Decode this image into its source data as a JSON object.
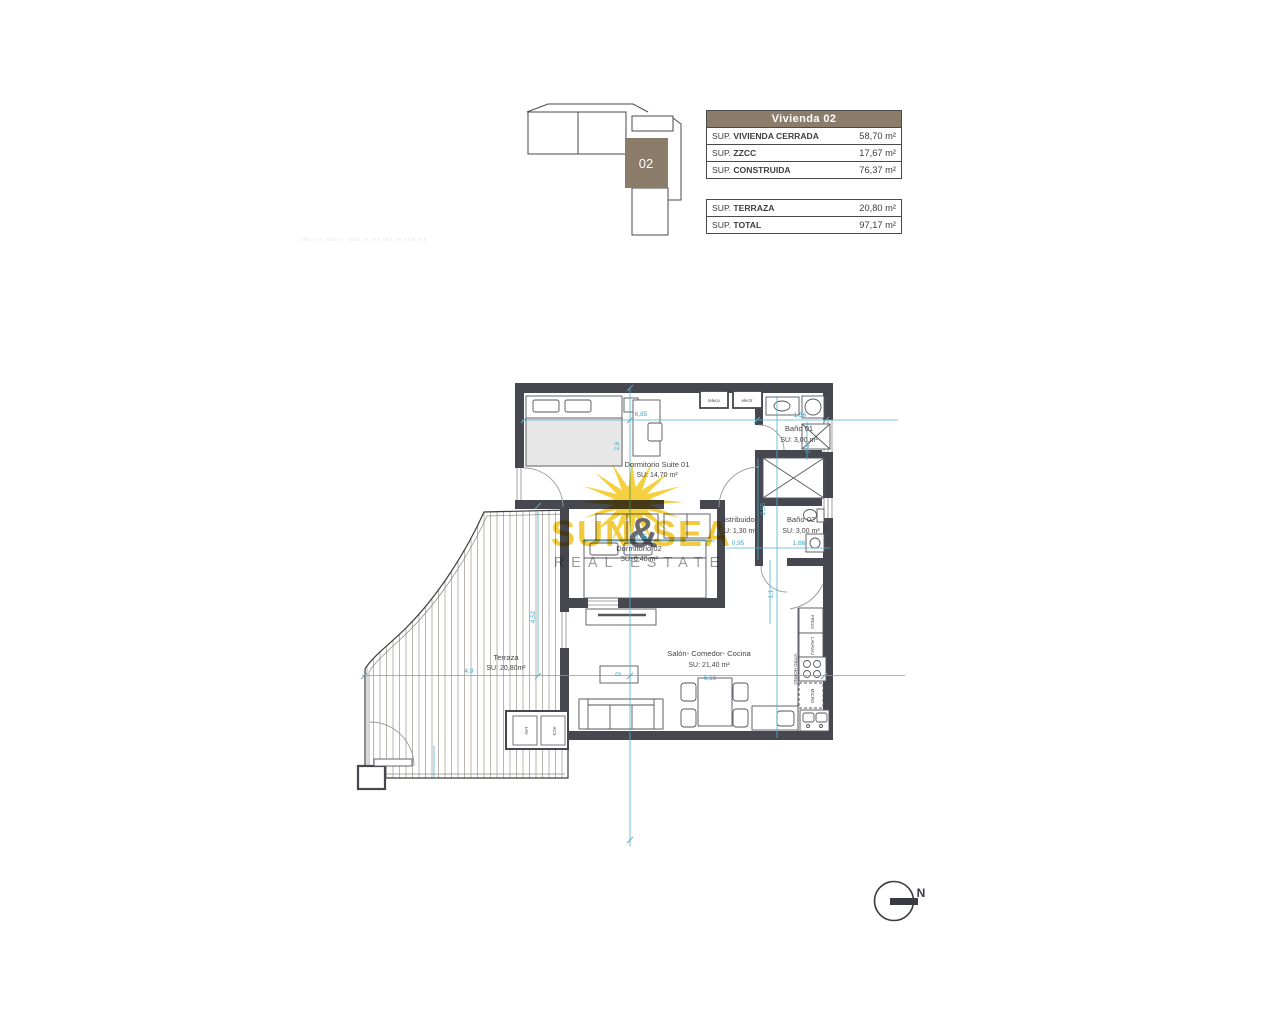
{
  "key_plan": {
    "unit": "02"
  },
  "area_table": {
    "header": "Vivienda 02",
    "rows_top": [
      {
        "prefix": "SUP. ",
        "name": "VIVIENDA CERRADA",
        "value": "58,70 m²"
      },
      {
        "prefix": "SUP. ",
        "name": "ZZCC",
        "value": "17,67 m²"
      },
      {
        "prefix": "SUP. ",
        "name": "CONSTRUIDA",
        "value": "76,37 m²"
      }
    ],
    "rows_bottom": [
      {
        "prefix": "SUP. ",
        "name": "TERRAZA",
        "value": "20,80 m²"
      },
      {
        "prefix": "SUP. ",
        "name": "TOTAL",
        "value": "97,17 m²"
      }
    ]
  },
  "caption_faint": "ıııı ııı ıııı ıı ııııı ıı ııı ıııı ıı ıııı ııı",
  "rooms": {
    "suite": {
      "name": "Dormitorio Suite  01",
      "area": "SU: 14,70 m²"
    },
    "bano01": {
      "name": "Baño 01",
      "area": "SU: 3,00 m²"
    },
    "distribuidor": {
      "name": "Distribuidor",
      "area": "SU: 1,30 m²"
    },
    "bano02": {
      "name": "Baño 02",
      "area": "SU: 3,00 m²"
    },
    "dorm02": {
      "name": "Dormitorio 02",
      "area": "SU: 8,40 m²"
    },
    "salon": {
      "name": "Salón- Comedor- Cocina",
      "area": "SU: 21,40 m²"
    },
    "terraza": {
      "name": "Terraza",
      "area": "SU: 20,80m²"
    }
  },
  "labels": {
    "teleco": "teleco",
    "electr": "electr",
    "frigo": "FRIGO",
    "lavavaj": "LAVAVAJ",
    "vitro": "VITRO HORNO",
    "micro": "MICRO",
    "lav": "LAV.",
    "acs": "ACS"
  },
  "dims": {
    "d1": "6,85",
    "d2": "2,6",
    "d3": "1,56",
    "d4": "2,45",
    "d5": "2,55",
    "d6": "0,95",
    "d7": "1,66",
    "d8": "3,45",
    "d9": "1,1",
    "d10": "6,16",
    "d11": "4,52",
    "d12": "4,9",
    "d13": "69"
  },
  "watermark": {
    "w1": "SUN",
    "amp": "&",
    "w2": "SEA",
    "tagline": "REAL ESTATE"
  },
  "compass": {
    "n": "N"
  },
  "colors": {
    "accent_brown": "#8c7d6b",
    "wall_gray": "#47474f",
    "dim_cyan": "#3ba6c6",
    "sun_yellow": "#f2c41e"
  }
}
